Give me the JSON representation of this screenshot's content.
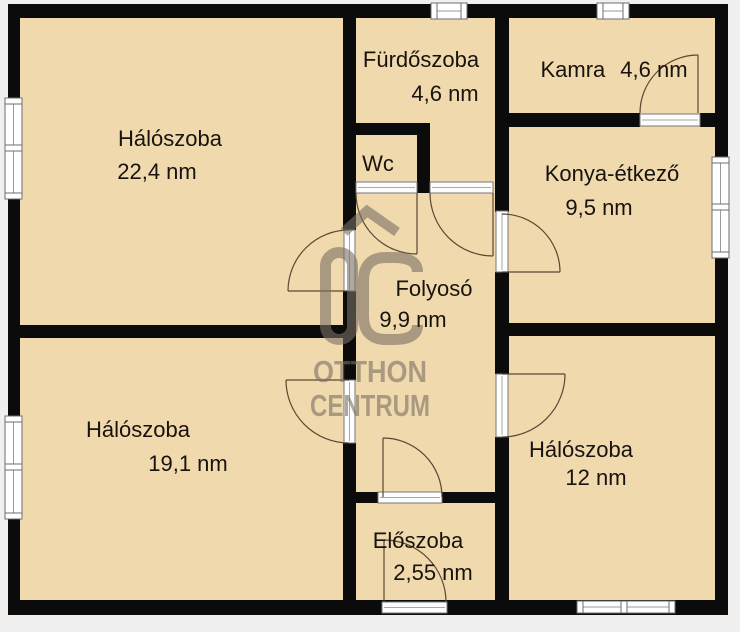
{
  "plan": {
    "rooms": [
      {
        "id": "bedroom-top-left",
        "name": "Hálószoba",
        "area": "22,4 nm"
      },
      {
        "id": "bathroom",
        "name": "Fürdőszoba",
        "area": "4,6 nm"
      },
      {
        "id": "pantry",
        "name": "Kamra",
        "area": "4,6 nm"
      },
      {
        "id": "wc",
        "name": "Wc",
        "area": ""
      },
      {
        "id": "kitchen-dining",
        "name": "Konya-étkező",
        "area": "9,5 nm"
      },
      {
        "id": "hallway",
        "name": "Folyosó",
        "area": "9,9 nm"
      },
      {
        "id": "bedroom-bottom-left",
        "name": "Hálószoba",
        "area": "19,1 nm"
      },
      {
        "id": "bedroom-bottom-right",
        "name": "Hálószoba",
        "area": "12 nm"
      },
      {
        "id": "entry-hall",
        "name": "Előszoba",
        "area": "2,55 nm"
      }
    ],
    "watermark": {
      "brand_line1": "OTTHON",
      "brand_line2": "CENTRUM"
    },
    "colors": {
      "floor": "#f0d9ad",
      "wall": "#0b0b0b",
      "background": "#f1f0ee",
      "watermark": "#7a7065",
      "door_swing": "#5a4733"
    }
  }
}
